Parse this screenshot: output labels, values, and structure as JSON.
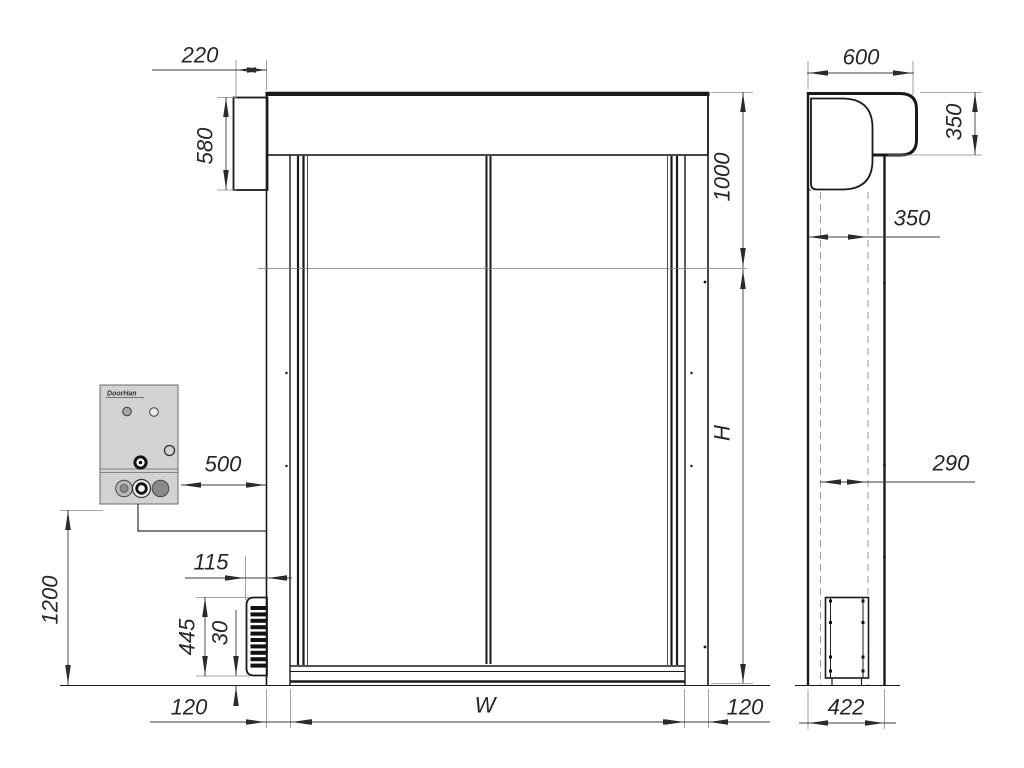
{
  "drawing": {
    "control_box": {
      "brand": "DoorHan"
    },
    "dimensions": {
      "hood_side_box_width": "220",
      "motor_housing_height": "580",
      "top_section_height": "1000",
      "door_height": "H",
      "control_box_offset": "500",
      "control_box_mount_height": "1200",
      "photocell_depth": "115",
      "photocell_housing_height": "445",
      "photocell_bottom_gap": "30",
      "left_column_width": "120",
      "door_width": "W",
      "right_column_width": "120",
      "hood_depth": "600",
      "hood_height": "350",
      "wall_to_curtain": "350",
      "roll_clearance": "290",
      "side_column_depth": "422"
    }
  }
}
